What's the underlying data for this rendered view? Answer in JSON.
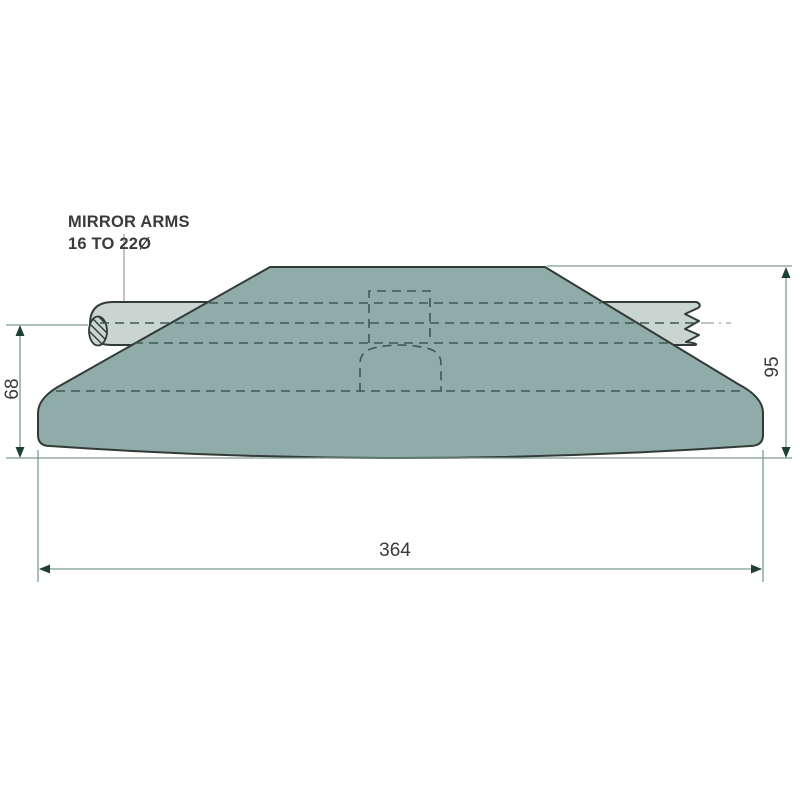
{
  "colors": {
    "background": "#ffffff",
    "body_fill": "#8FACA9",
    "arm_fill": "#C8D5D0",
    "outline": "#333B39",
    "hidden_line": "#3E5855",
    "dim_line": "#7C9B93",
    "arrow": "#1F4038",
    "text": "#3A3A3A",
    "centerline": "#93A39E"
  },
  "callout": {
    "line1": "MIRROR ARMS",
    "line2": "16 TO 22Ø"
  },
  "dimensions": {
    "arm_center_to_base": "68",
    "overall_height": "95",
    "overall_width": "364"
  }
}
